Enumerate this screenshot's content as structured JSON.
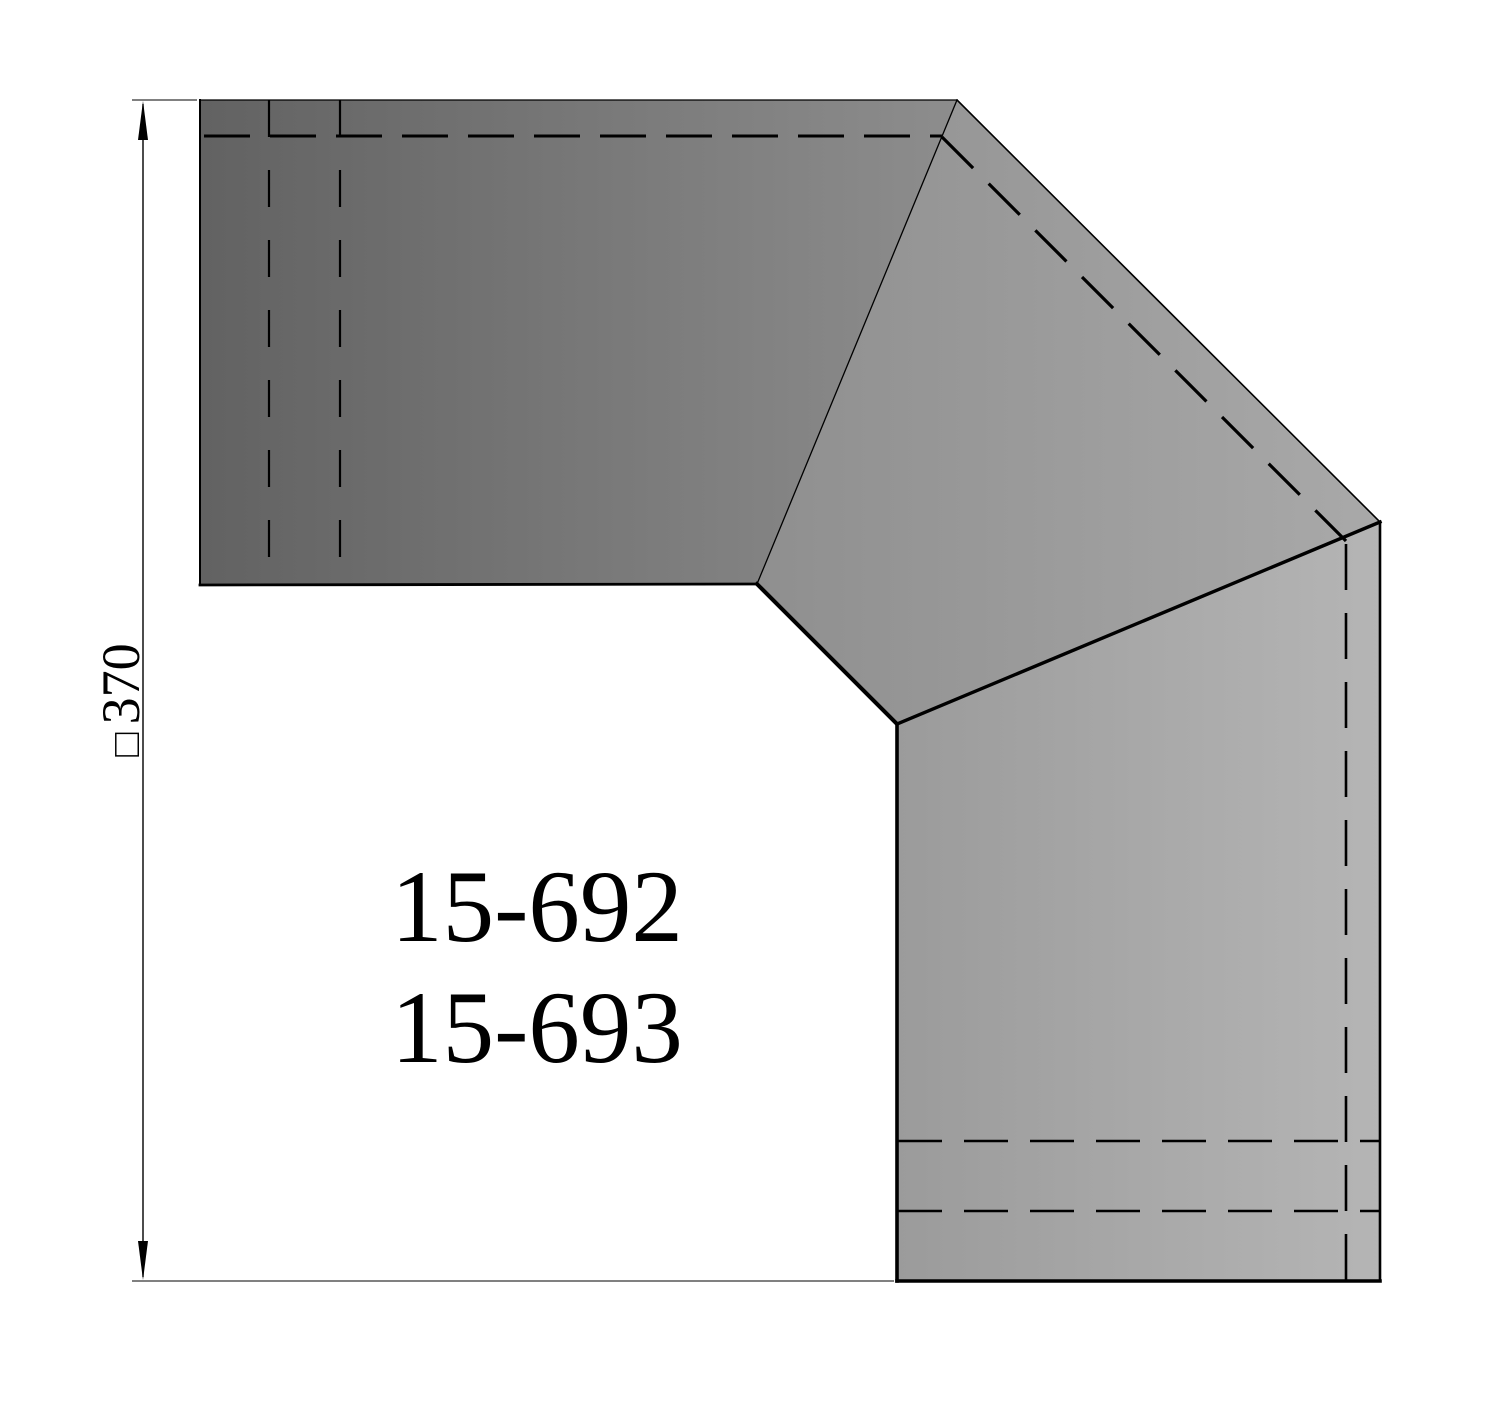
{
  "part_labels": {
    "line1": "15-692",
    "line2": "15-693"
  },
  "dimension": {
    "symbol": "□",
    "value": "370"
  },
  "colors": {
    "background": "#ffffff",
    "outline": "#000000",
    "inlet_dark": "#626262",
    "inlet_light": "#8d8d8d",
    "middle_dark": "#8f8f8f",
    "middle_light": "#a9a9a9",
    "outlet_dark": "#9b9b9b",
    "outlet_light": "#b5b5b5"
  }
}
